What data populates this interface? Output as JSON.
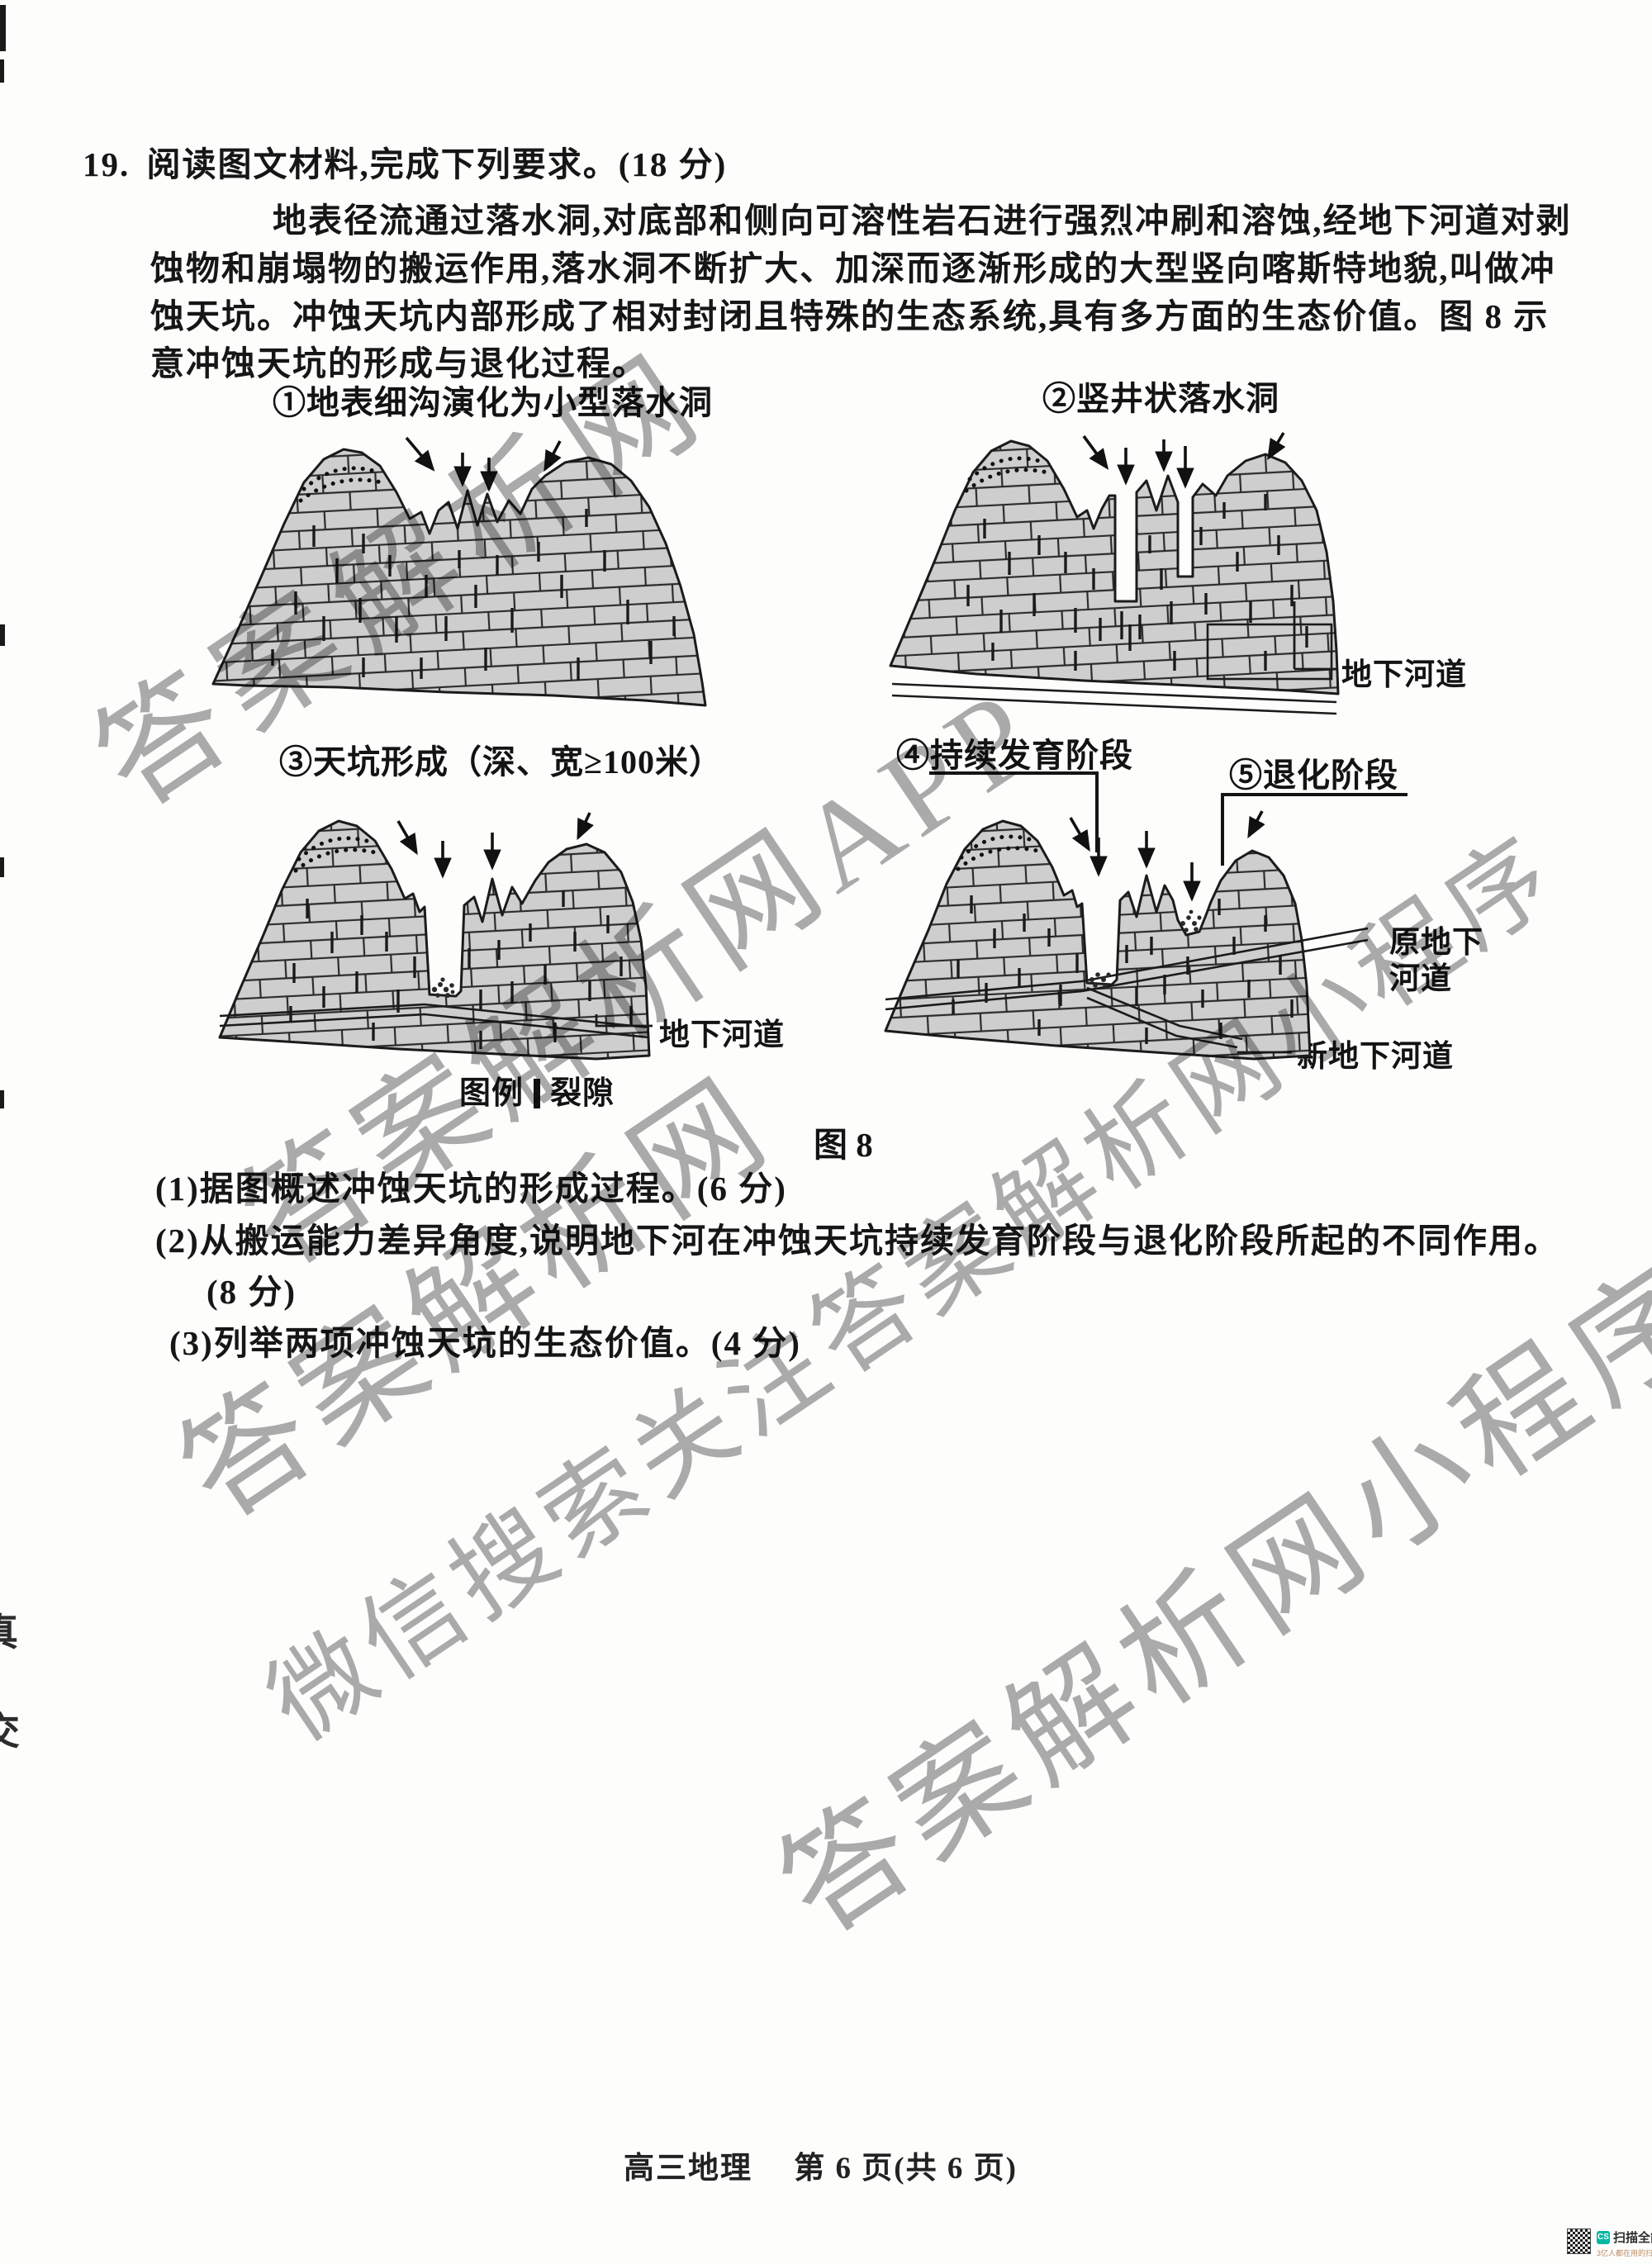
{
  "document": {
    "footer": "高三地理　 第 6 页(共 6 页)",
    "edge_marks": [
      "真",
      "交"
    ]
  },
  "question": {
    "number": "19.",
    "stem": "阅读图文材料,完成下列要求。(18 分)",
    "paragraph": [
      "地表径流通过落水洞,对底部和侧向可溶性岩石进行强烈冲刷和溶蚀,经地下河道对剥",
      "蚀物和崩塌物的搬运作用,落水洞不断扩大、加深而逐渐形成的大型竖向喀斯特地貌,叫做冲",
      "蚀天坑。冲蚀天坑内部形成了相对封闭且特殊的生态系统,具有多方面的生态价值。图 8 示",
      "意冲蚀天坑的形成与退化过程。"
    ],
    "subquestions": [
      "(1)据图概述冲蚀天坑的形成过程。(6 分)",
      "(2)从搬运能力差异角度,说明地下河在冲蚀天坑持续发育阶段与退化阶段所起的不同作用。",
      "(8 分)",
      "(3)列举两项冲蚀天坑的生态价值。(4 分)"
    ]
  },
  "figure": {
    "caption": "图 8",
    "panel1_title": "①地表细沟演化为小型落水洞",
    "panel2_title": "②竖井状落水洞",
    "panel3_title": "③天坑形成（深、宽≥100米）",
    "panel4_title": "④持续发育阶段",
    "panel5_title": "⑤退化阶段",
    "label_underground_channel_2": "地下河道",
    "label_underground_channel_3": "地下河道",
    "label_old_channel_line1": "原地下",
    "label_old_channel_line2": "河道",
    "label_new_channel": "新地下河道",
    "legend_title": "图例",
    "legend_item": "裂隙"
  },
  "watermarks": {
    "wm1": "答案解析网",
    "wm2": "答案解析网APP",
    "wm3": "答案解析网",
    "wm4": "微信搜索关注答案解析网小程序",
    "wm5": "答案解析网小程序"
  },
  "scanner_badge": {
    "icon": "CS",
    "app_name": "扫描全能王",
    "tagline": "3亿人都在用的扫描App"
  },
  "colors": {
    "badge_teal": "#00b7a5",
    "watermark_gray": "#757575",
    "rock_fill": "#cecece"
  }
}
